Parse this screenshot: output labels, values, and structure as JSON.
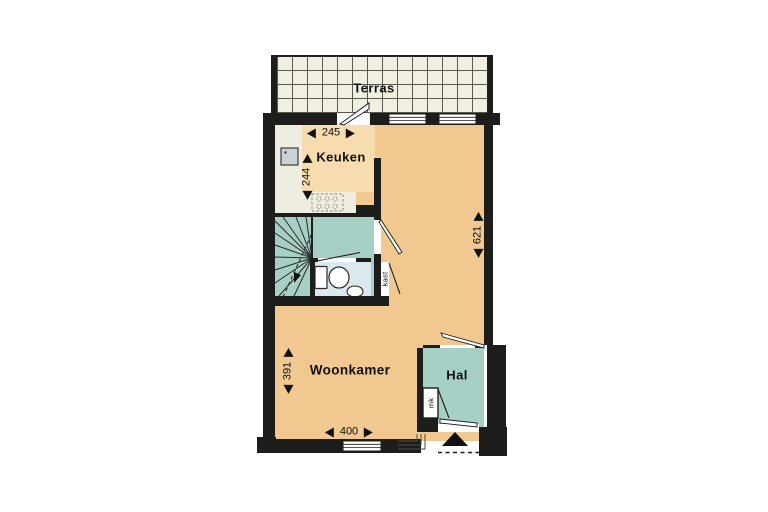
{
  "plan": {
    "rooms": {
      "terrace": {
        "label": "Terras"
      },
      "kitchen": {
        "label": "Keuken"
      },
      "living_room": {
        "label": "Woonkamer"
      },
      "hall": {
        "label": "Hal"
      },
      "closet": {
        "label": "kast"
      },
      "meter_cupboard": {
        "label": "mk"
      }
    },
    "dimensions": {
      "kitchen_width": {
        "value": "245",
        "orientation": "horizontal"
      },
      "kitchen_depth": {
        "value": "244",
        "orientation": "vertical"
      },
      "overall_depth": {
        "value": "621",
        "orientation": "vertical"
      },
      "living_depth": {
        "value": "391",
        "orientation": "vertical"
      },
      "living_width": {
        "value": "400",
        "orientation": "horizontal"
      }
    }
  },
  "colors": {
    "wall": "#1d1d1b",
    "living": "#f0c890",
    "kitchen": "#f6dcae",
    "counter": "#efece0",
    "teal": "#a6cfc6",
    "wc": "#dbe8ed",
    "tile": "#f1eee2",
    "grid": "#5a594f"
  }
}
